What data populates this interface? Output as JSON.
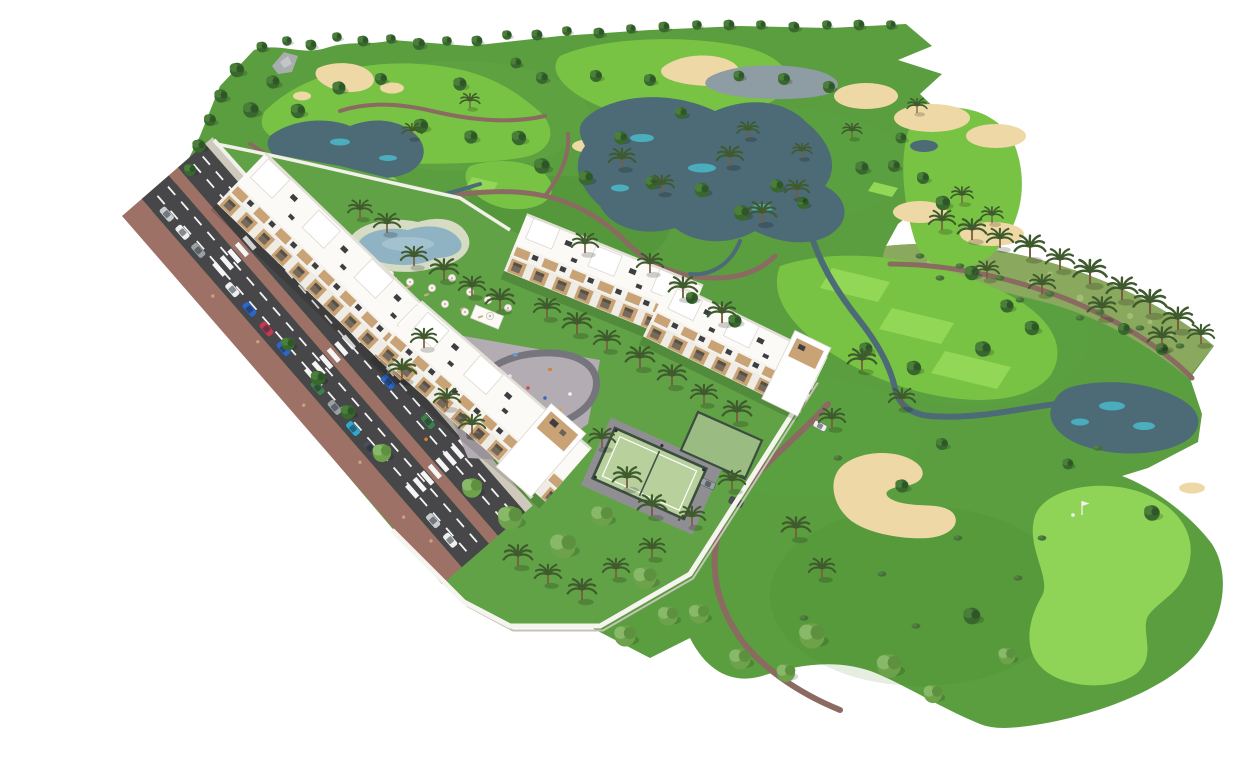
{
  "meta": {
    "width": 1240,
    "height": 726,
    "title": "Aerial 3D render of a golf-resort apartment complex"
  },
  "scene": {
    "background": "#ffffff",
    "description": "Isometric aerial architectural render: two long white apartment blocks with rooftop terraces, a swimming pool with umbrellas, a playground plaza and padel courts enclosed by a white wall, set beside a golf course with lakes, streams, sand bunkers, fairways, tee boxes, a putting green with flag, palm trees, and a diagonal access road with parked cars and zebra crossings.",
    "features": [
      "golf-course",
      "fairway",
      "tee-box",
      "putting-green",
      "golf-flag",
      "lake",
      "stream",
      "sand-bunker",
      "cart-path",
      "scrubland",
      "palm-tree",
      "tree",
      "apartment-building",
      "rooftop-terrace",
      "penthouse",
      "swimming-pool",
      "pool-umbrella",
      "playground-plaza",
      "padel-court",
      "court-fence",
      "perimeter-wall",
      "access-road",
      "sidewalk",
      "median",
      "zebra-crossing",
      "parked-car",
      "garden"
    ],
    "counts": {
      "apartment_building_segments": 4,
      "swimming_pools": 1,
      "padel_courts": 2,
      "golf_flags": 2,
      "lakes": 4,
      "sand_bunker_clusters": 9,
      "zebra_crossings": 3,
      "parked_cars": 13
    }
  },
  "colors": {
    "background": "#ffffff",
    "grass": "#5a9e3f",
    "grassLight": "#6db14c",
    "grassDark": "#4a8833",
    "lawn": "#61a246",
    "fairway": "#78c344",
    "tee": "#93d756",
    "green": "#8fd457",
    "scrub": "#8aa85e",
    "sand": "#eed9a6",
    "sandDark": "#ddc188",
    "lake": "#4c6b76",
    "lakeHighlight": "#4ac4d6",
    "lakeGray": "#8e9ca3",
    "path": "#8b6a62",
    "road": "#474749",
    "roadLine": "#f5f5f5",
    "sidewalk": "#9d7166",
    "innerWalk": "#cfc9bd",
    "plaza": "#b4acb3",
    "plazaPath": "#76747c",
    "court": "#b7d09c",
    "courtFence": "#3c4c40",
    "pool": "#8fb3c2",
    "poolDeck": "#ebe6da",
    "building": "#fbfaf7",
    "buildingShade": "#e2dfd7",
    "balcony": "#c9a273",
    "deck": "#c9a376",
    "roofDetail": "#3e3e42",
    "wall": "#f6f4ee",
    "wallShadow": "#c6c2b8",
    "treeDark": "#335c2a",
    "treeMid": "#4a7f39",
    "treeLight": "#87b968",
    "palm": "#3f5a2c",
    "trunk": "#7a5c3e",
    "carColors": [
      "#eef0f0",
      "#2d66c8",
      "#c03a50",
      "#3f7f4a",
      "#2fa8cc",
      "#9aa0a4",
      "#c9ccce",
      "#4a4f55"
    ]
  }
}
